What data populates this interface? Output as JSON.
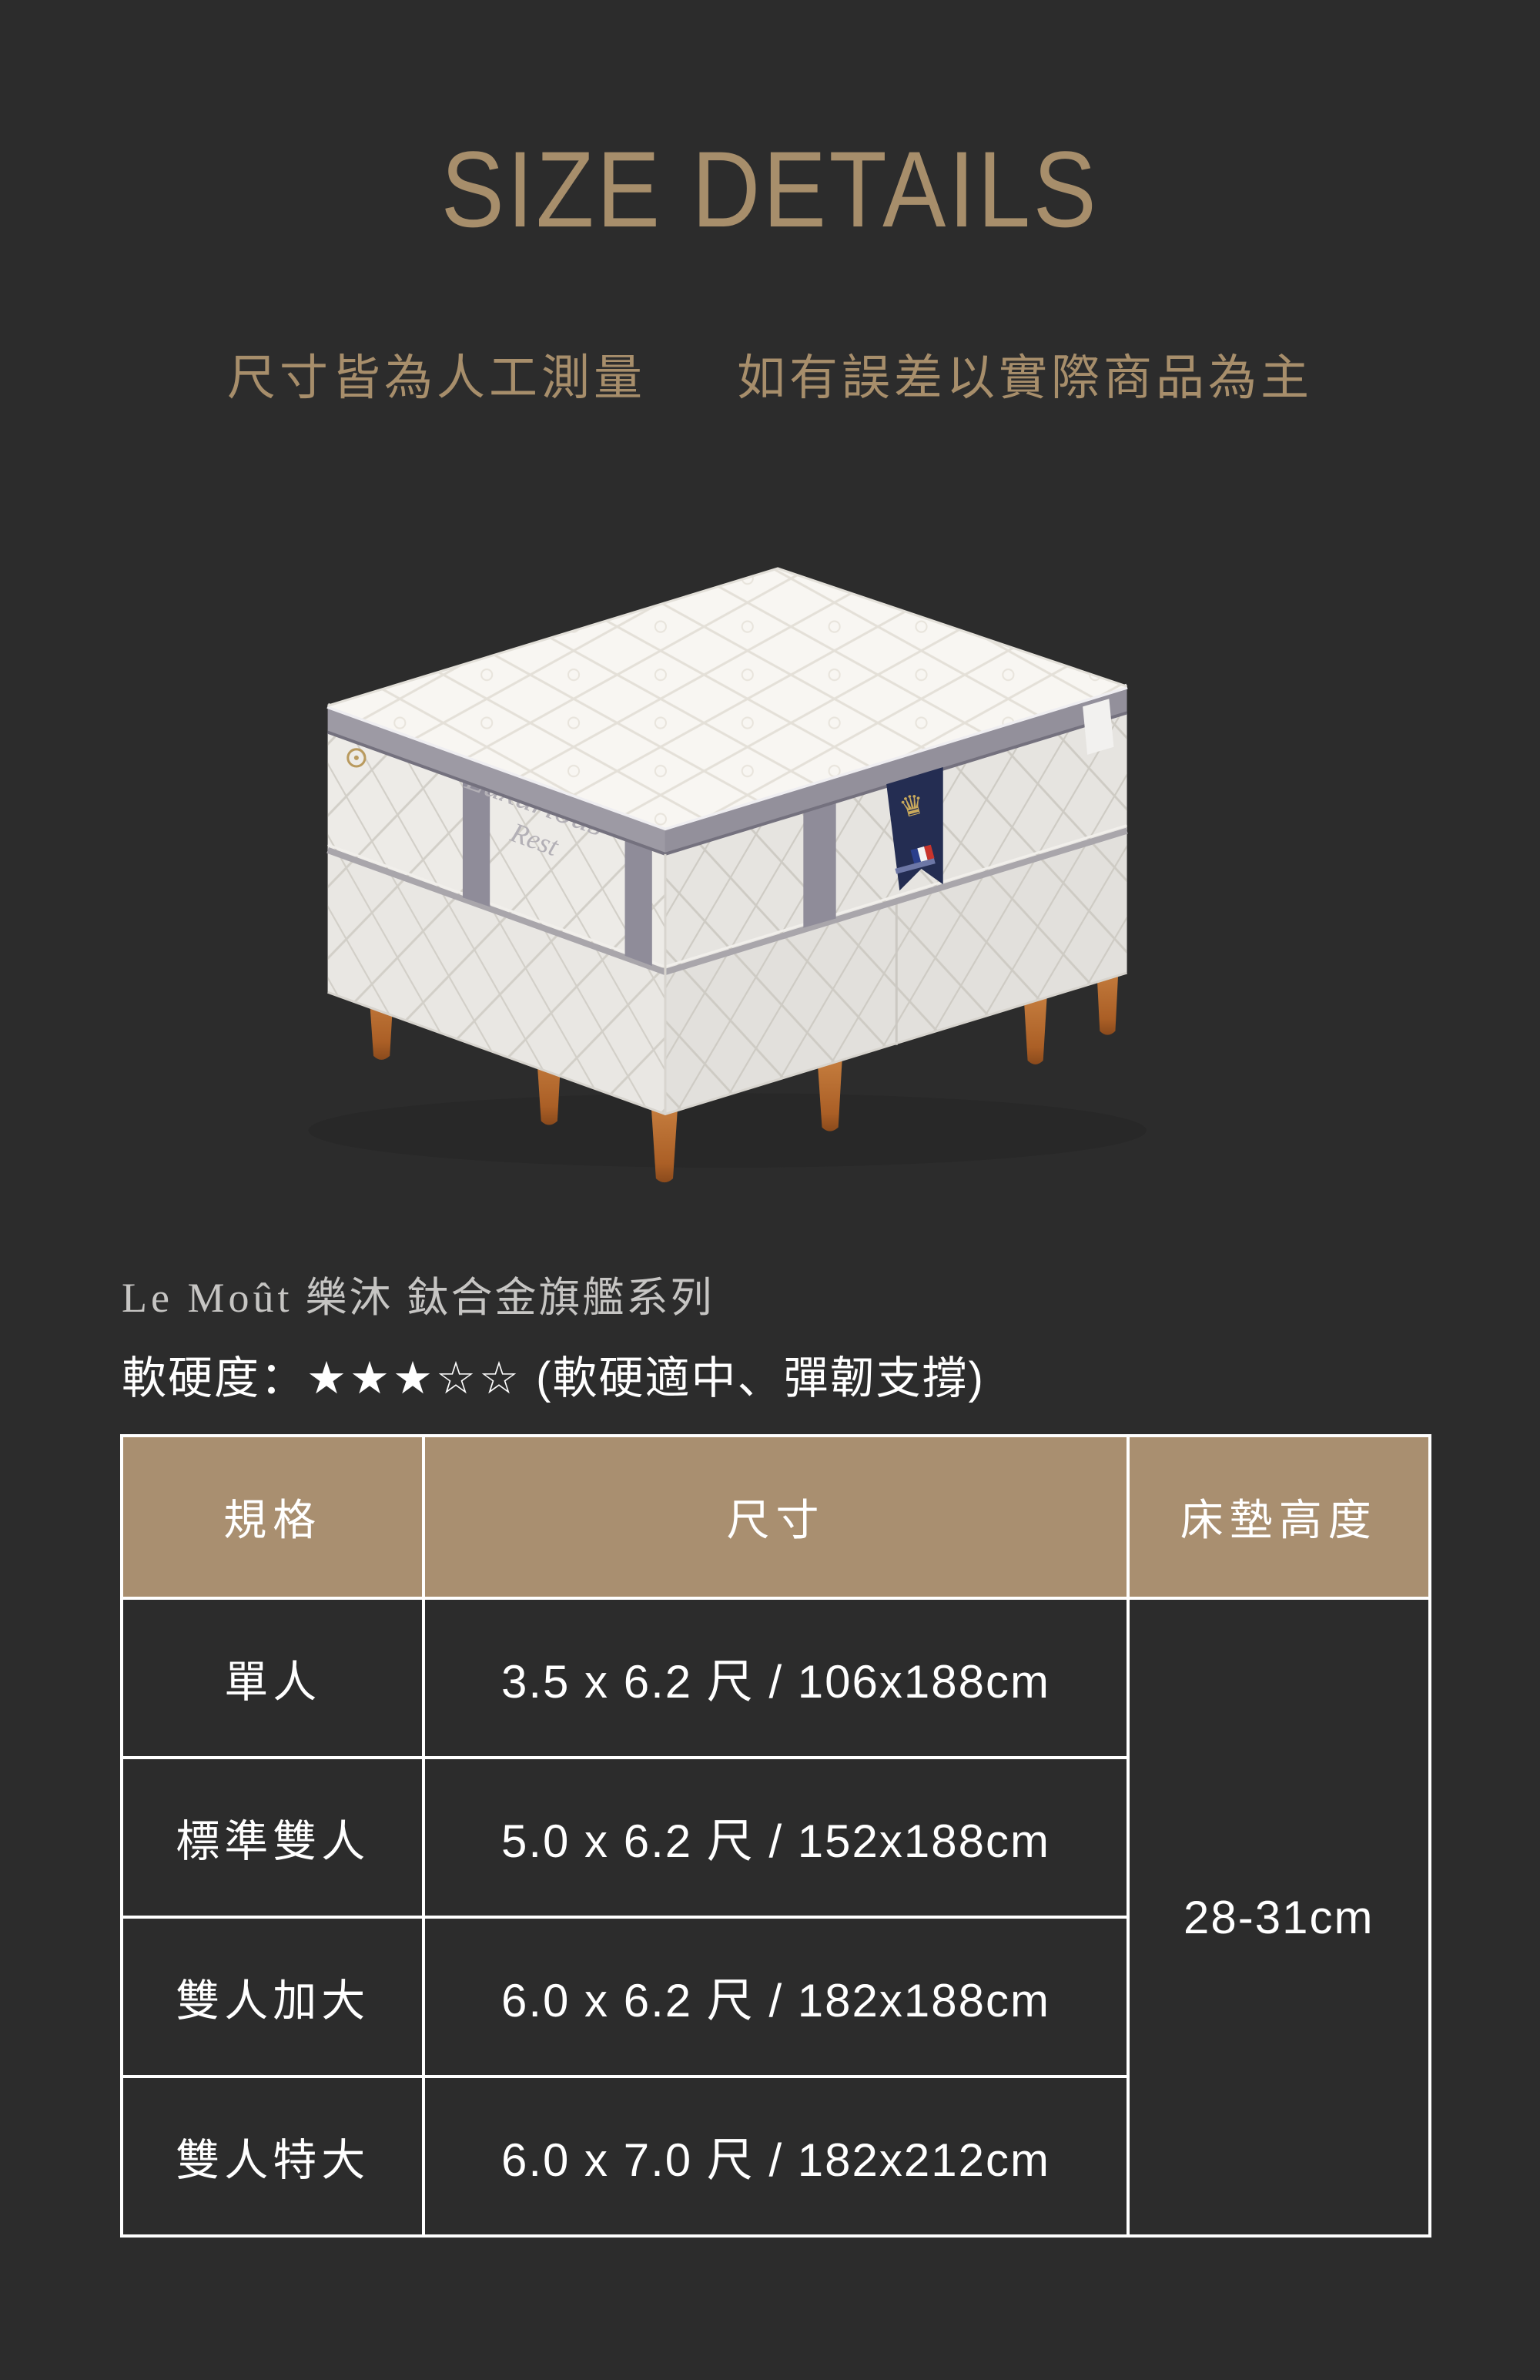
{
  "page": {
    "title": "SIZE DETAILS",
    "subtitle_left": "尺寸皆為人工測量",
    "subtitle_right": "如有誤差以實際商品為主"
  },
  "product": {
    "series_latin": "Le Moût",
    "series_cjk": "樂沐 鈦合金旗艦系列",
    "firmness_label": "軟硬度：",
    "firmness_stars": "★★★☆☆",
    "firmness_note": "(軟硬適中、彈韌支撐)"
  },
  "mattress": {
    "side_text_line1": "Luxurious",
    "side_text_line2": "Rest"
  },
  "size_table": {
    "headers": [
      "規格",
      "尺寸",
      "床墊高度"
    ],
    "rows": [
      {
        "spec": "單人",
        "size": "3.5 x 6.2 尺 / 106x188cm"
      },
      {
        "spec": "標準雙人",
        "size": "5.0 x 6.2 尺 / 152x188cm"
      },
      {
        "spec": "雙人加大",
        "size": "6.0 x 6.2 尺 / 182x188cm"
      },
      {
        "spec": "雙人特大",
        "size": "6.0 x 7.0 尺 / 182x212cm"
      }
    ],
    "height_merged": "28-31cm"
  },
  "colors": {
    "background": "#2c2c2c",
    "accent_tan": "#a78e6b",
    "table_header_bg": "#a98f70",
    "table_border": "#ffffff",
    "text_white": "#ffffff",
    "series_gray": "#c6c5c3",
    "leg_orange": "#b5682a",
    "tag_navy": "#242d52"
  }
}
